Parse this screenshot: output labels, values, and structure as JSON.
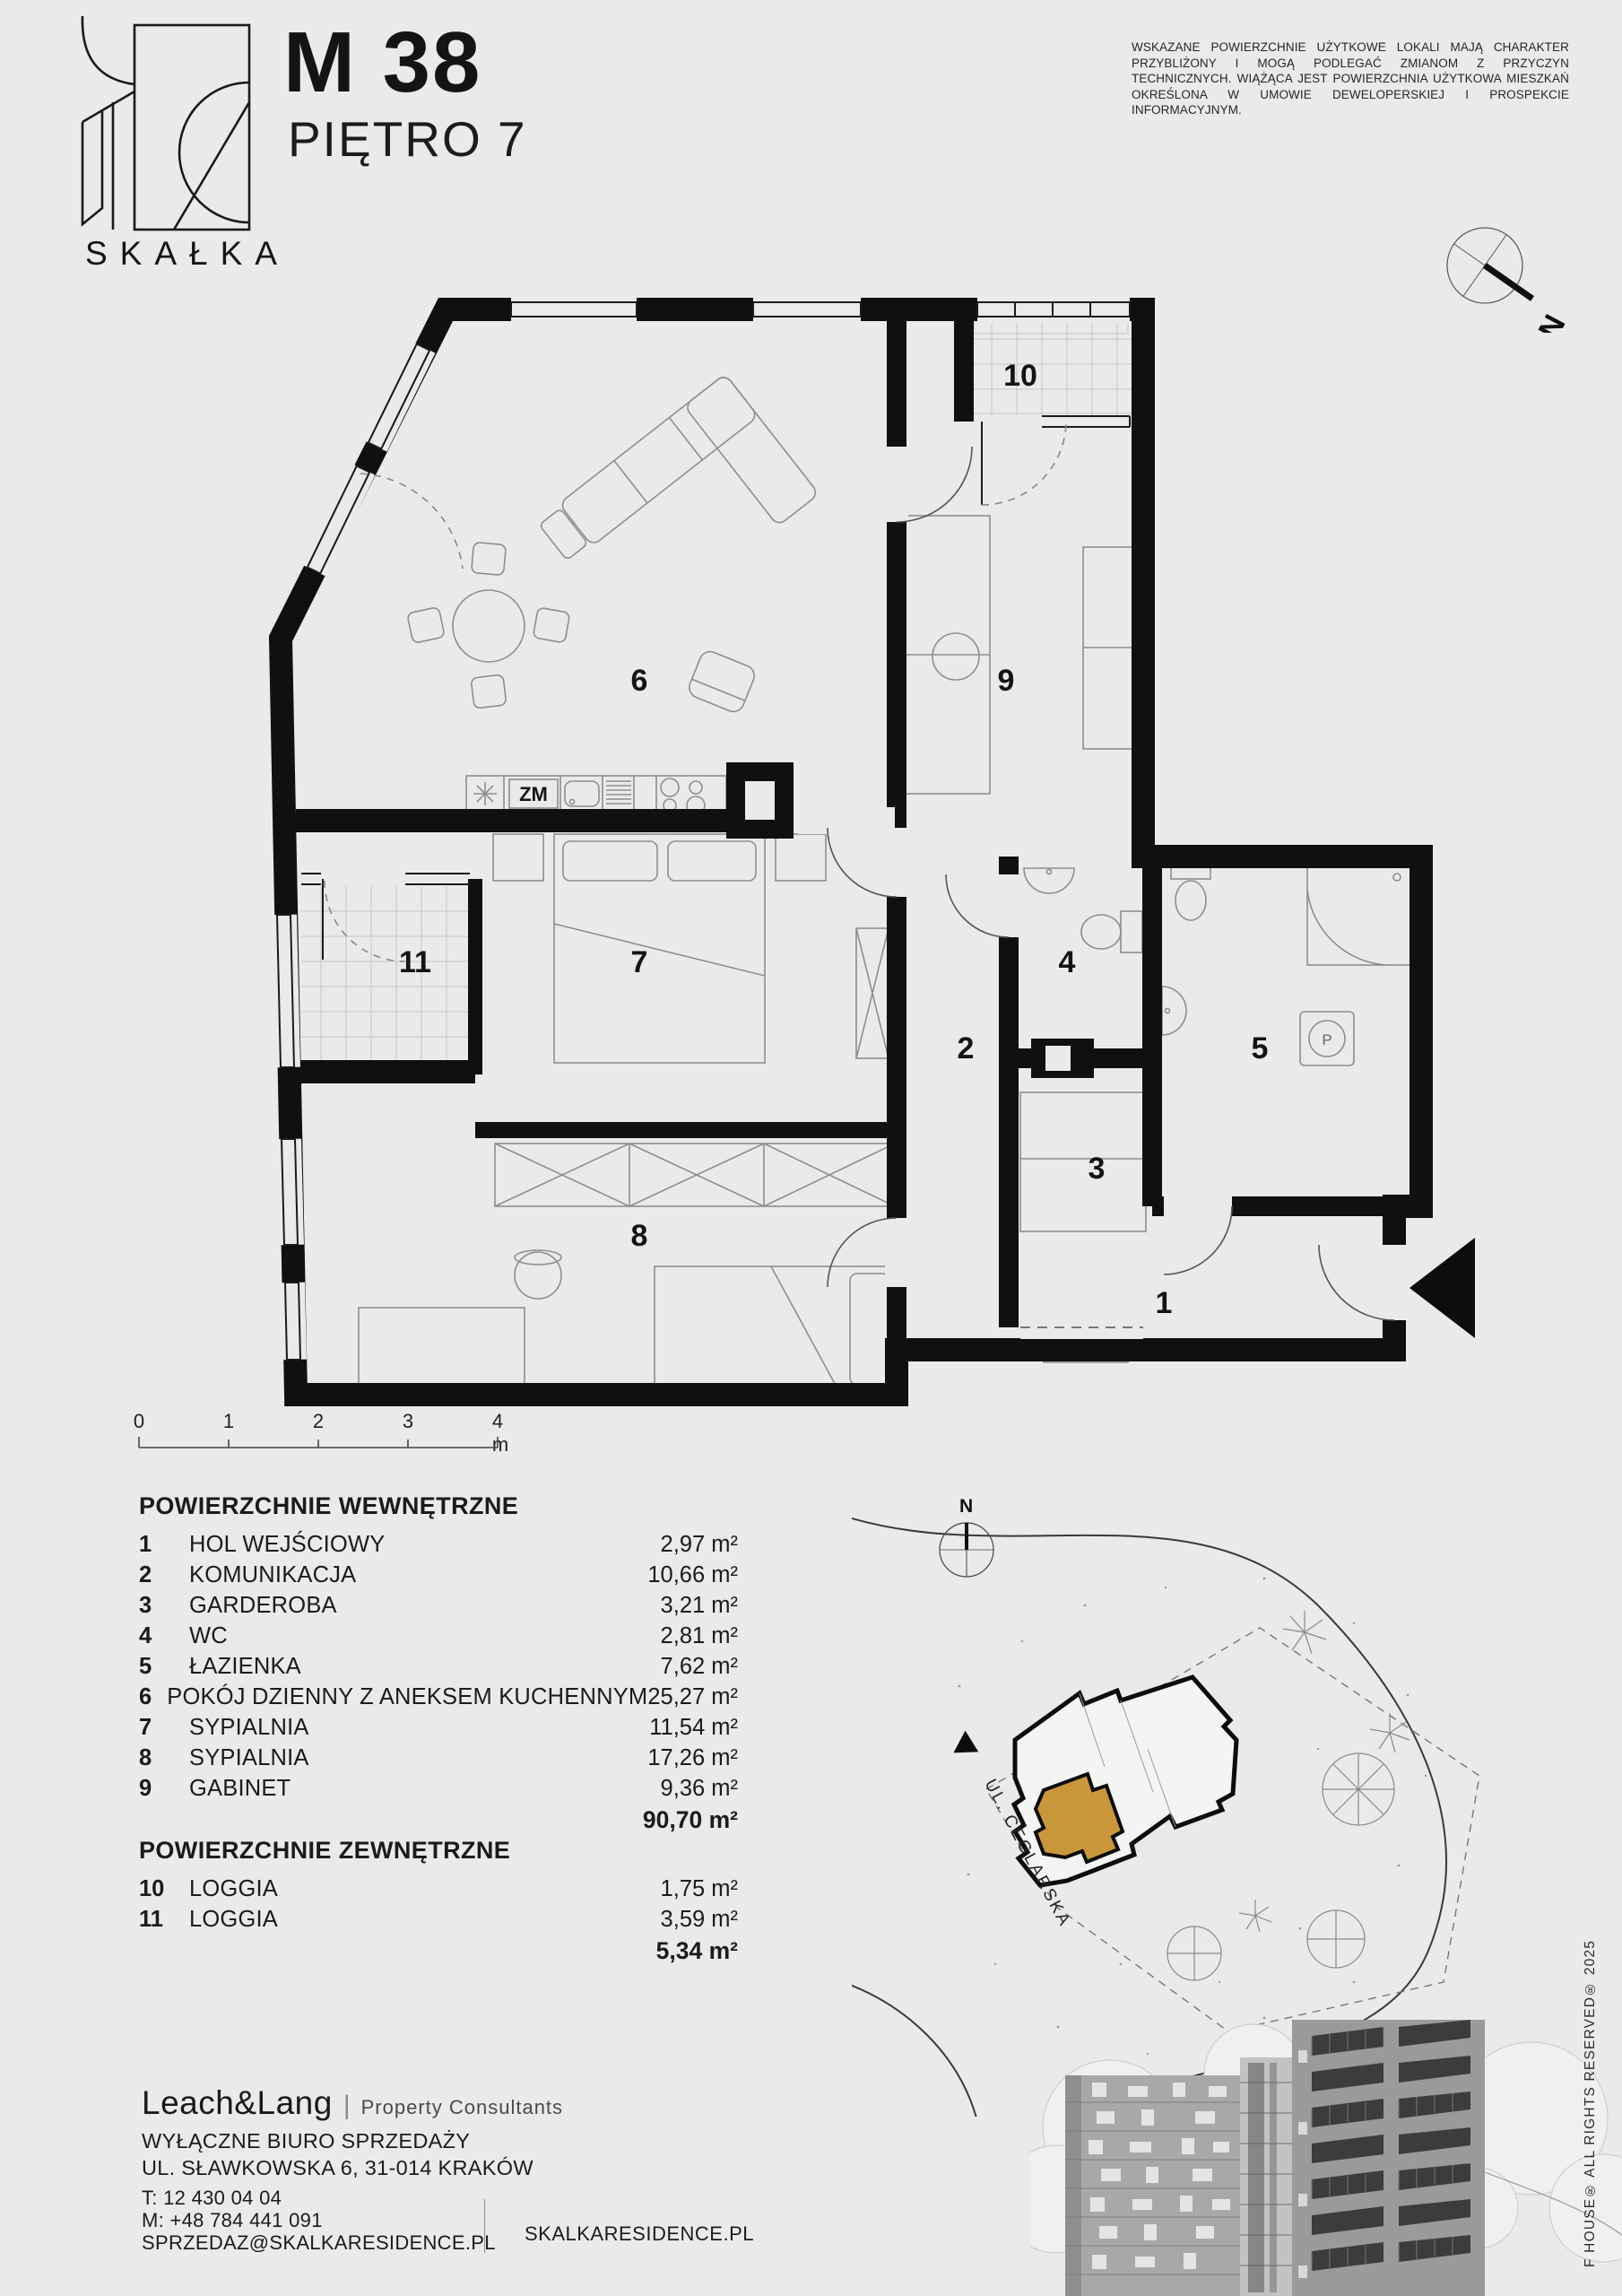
{
  "page": {
    "bg": "#eaeae8",
    "accent_gold": "#c9973b"
  },
  "header": {
    "brand": "SKAŁKA",
    "unit_id": "M 38",
    "floor_label": "PIĘTRO 7",
    "disclaimer": "WSKAZANE POWIERZCHNIE UŻYTKOWE LOKALI MAJĄ CHARAKTER PRZYBLIŻONY I MOGĄ PODLEGAĆ ZMIANOM Z PRZYCZYN TECHNICZNYCH. WIĄŻĄCA JEST POWIERZCHNIA UŻYTKOWA MIESZKAŃ OKREŚLONA W UMOWIE DEWELOPERSKIEJ I PROSPEKCIE INFORMACYJNYM.",
    "compass_north": "N"
  },
  "plan": {
    "rooms": [
      "1",
      "2",
      "3",
      "4",
      "5",
      "6",
      "7",
      "8",
      "9",
      "10",
      "11"
    ],
    "kitchen_label": "ZM",
    "washer_label": "P"
  },
  "scalebar": {
    "ticks": [
      "0",
      "1",
      "2",
      "3",
      "4 m"
    ]
  },
  "areas_internal": {
    "title": "POWIERZCHNIE WEWNĘTRZNE",
    "rows": [
      {
        "num": "1",
        "label": "HOL WEJŚCIOWY",
        "area": "2,97 m²"
      },
      {
        "num": "2",
        "label": "KOMUNIKACJA",
        "area": "10,66 m²"
      },
      {
        "num": "3",
        "label": "GARDEROBA",
        "area": "3,21 m²"
      },
      {
        "num": "4",
        "label": "WC",
        "area": "2,81 m²"
      },
      {
        "num": "5",
        "label": "ŁAZIENKA",
        "area": "7,62 m²"
      },
      {
        "num": "6",
        "label": "POKÓJ DZIENNY Z ANEKSEM KUCHENNYM",
        "area": "25,27 m²"
      },
      {
        "num": "7",
        "label": "SYPIALNIA",
        "area": "11,54 m²"
      },
      {
        "num": "8",
        "label": "SYPIALNIA",
        "area": "17,26 m²"
      },
      {
        "num": "9",
        "label": "GABINET",
        "area": "9,36 m²"
      }
    ],
    "total": "90,70 m²"
  },
  "areas_external": {
    "title": "POWIERZCHNIE ZEWNĘTRZNE",
    "rows": [
      {
        "num": "10",
        "label": "LOGGIA",
        "area": "1,75 m²"
      },
      {
        "num": "11",
        "label": "LOGGIA",
        "area": "3,59 m²"
      }
    ],
    "total": "5,34 m²"
  },
  "siteplan": {
    "street_label": "UL. CEGLARSKA",
    "north_label": "N"
  },
  "footer": {
    "agency_name": "Leach&Lang",
    "agency_divider": "|",
    "agency_tagline": "Property Consultants",
    "office_line1": "WYŁĄCZNE BIURO SPRZEDAŻY",
    "office_line2": "UL. SŁAWKOWSKA 6, 31-014 KRAKÓW",
    "phone_landline": "T: 12 430 04 04",
    "phone_mobile": "M: +48 784 441 091",
    "email": "SPRZEDAZ@SKALKARESIDENCE.PL",
    "website": "SKALKARESIDENCE.PL",
    "rights_vertical": "F HOUSE® ALL RIGHTS RESERVED® 2025"
  }
}
